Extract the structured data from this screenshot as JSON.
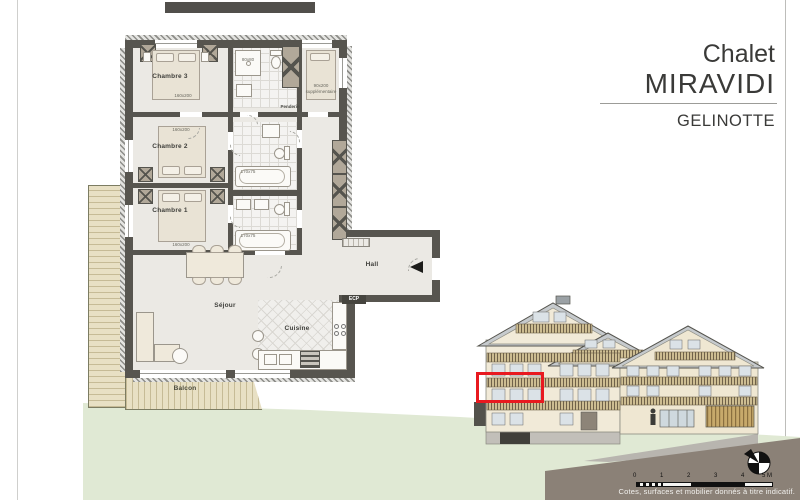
{
  "title_block": {
    "line1": "Chalet",
    "line2": "MIRAVIDI",
    "unit": "GELINOTTE"
  },
  "plan": {
    "rooms": {
      "chambre3": {
        "label": "Chambre 3",
        "bed": "160x200"
      },
      "chambre2": {
        "label": "Chambre 2",
        "bed": "160x200"
      },
      "chambre1": {
        "label": "Chambre 1",
        "bed": "160x200"
      },
      "hall": {
        "label": "Hall"
      },
      "sejour": {
        "label": "Séjour"
      },
      "cuisine": {
        "label": "Cuisine"
      },
      "balcon": {
        "label": "Balcon"
      }
    },
    "labels": {
      "penderie": "Penderie",
      "extra_bed_line1": "90x200",
      "extra_bed_line2": "supplémentaire",
      "bathtub1": "170x75",
      "bathtub2": "170x75",
      "shower": "80x80",
      "tech_box": "ECP"
    }
  },
  "elevation": {
    "highlight_color": "#e8191f"
  },
  "scale_bar": {
    "ticks": [
      "0",
      "1",
      "2",
      "3",
      "4",
      "5 M"
    ]
  },
  "footer": {
    "disclaimer": "Cotes, surfaces et mobilier donnés à titre indicatif."
  }
}
